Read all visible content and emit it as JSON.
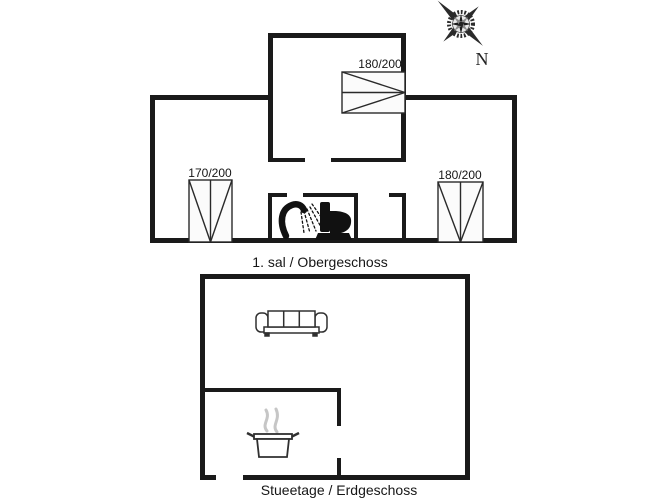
{
  "page": {
    "width": 667,
    "height": 500,
    "background": "#ffffff"
  },
  "floors": {
    "upper": {
      "caption": "1. sal / Obergeschoss"
    },
    "ground": {
      "caption": "Stueetage / Erdgeschoss"
    }
  },
  "beds": {
    "attic": {
      "label": "180/200"
    },
    "left": {
      "label": "170/200"
    },
    "right": {
      "label": "180/200"
    }
  },
  "compass": {
    "north_label": "N"
  },
  "icons": {
    "shower": "shower-icon",
    "toilet": "toilet-icon",
    "sofa": "sofa-icon",
    "cooking_pot": "cooking-pot-icon",
    "steam": "steam-icon",
    "compass_rose": "compass-rose-icon"
  },
  "colors": {
    "wall": "#1a1a1a",
    "furniture_line": "#303030",
    "bed_fill": "#fbfbfb",
    "steam": "#c6c6c6",
    "compass": "#2b2b2b",
    "text": "#161616"
  }
}
